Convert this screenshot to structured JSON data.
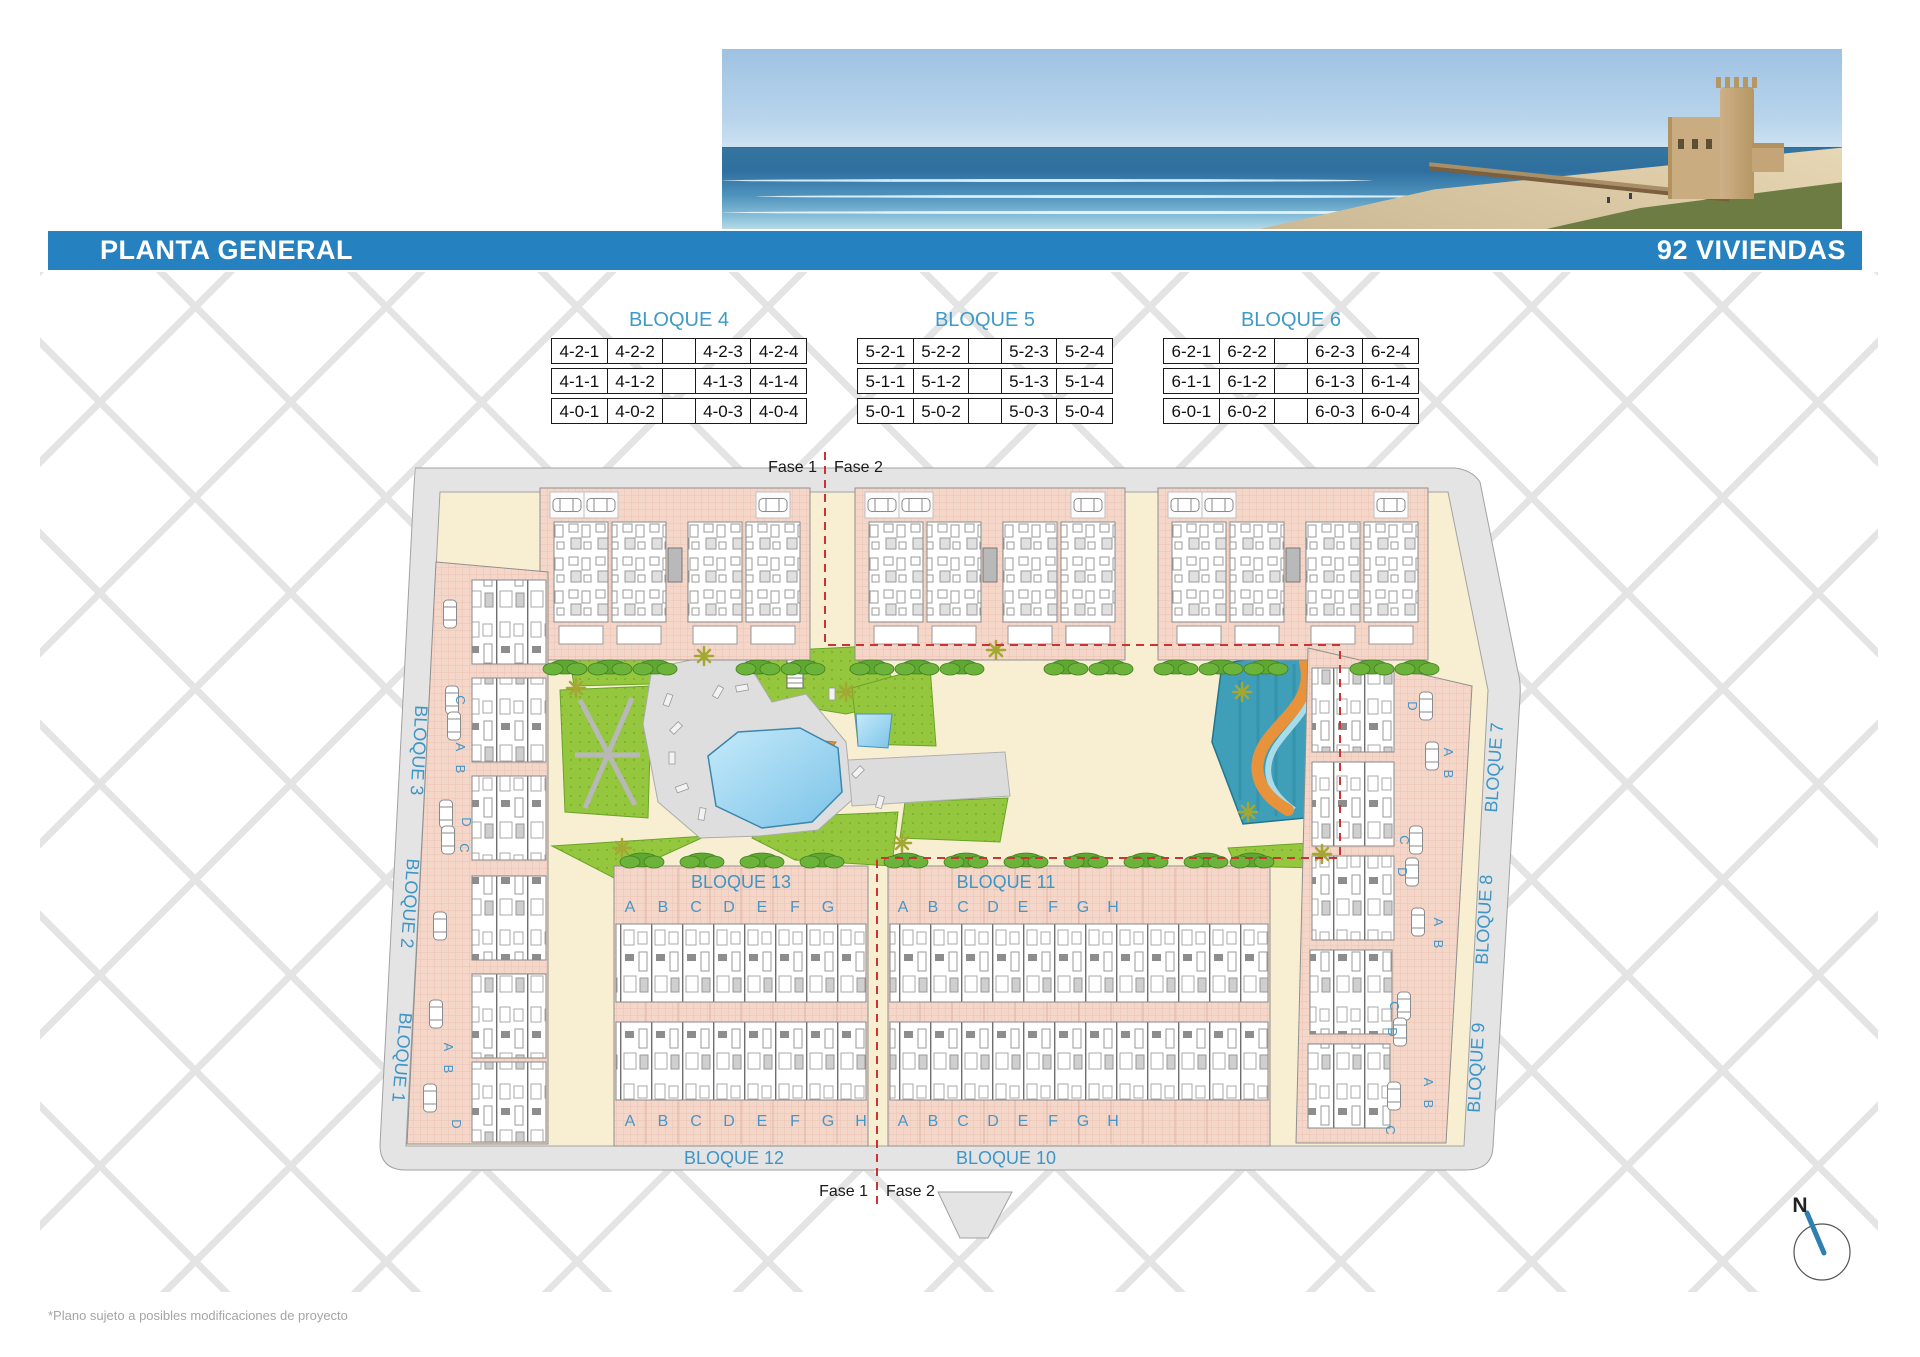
{
  "header": {
    "title": "PLANTA GENERAL",
    "badge": "92 VIVIENDAS"
  },
  "legend_tables": [
    {
      "title": "BLOQUE 4",
      "rows": [
        [
          "4-2-1",
          "4-2-2",
          "",
          "4-2-3",
          "4-2-4"
        ],
        [
          "4-1-1",
          "4-1-2",
          "",
          "4-1-3",
          "4-1-4"
        ],
        [
          "4-0-1",
          "4-0-2",
          "",
          "4-0-3",
          "4-0-4"
        ]
      ]
    },
    {
      "title": "BLOQUE 5",
      "rows": [
        [
          "5-2-1",
          "5-2-2",
          "",
          "5-2-3",
          "5-2-4"
        ],
        [
          "5-1-1",
          "5-1-2",
          "",
          "5-1-3",
          "5-1-4"
        ],
        [
          "5-0-1",
          "5-0-2",
          "",
          "5-0-3",
          "5-0-4"
        ]
      ]
    },
    {
      "title": "BLOQUE 6",
      "rows": [
        [
          "6-2-1",
          "6-2-2",
          "",
          "6-2-3",
          "6-2-4"
        ],
        [
          "6-1-1",
          "6-1-2",
          "",
          "6-1-3",
          "6-1-4"
        ],
        [
          "6-0-1",
          "6-0-2",
          "",
          "6-0-3",
          "6-0-4"
        ]
      ]
    }
  ],
  "phase": {
    "fase1": "Fase 1",
    "fase2": "Fase 2"
  },
  "plan": {
    "labels": {
      "b1": "BLOQUE 1",
      "b2": "BLOQUE 2",
      "b3": "BLOQUE 3",
      "b7": "BLOQUE 7",
      "b8": "BLOQUE 8",
      "b9": "BLOQUE 9",
      "b10": "BLOQUE 10",
      "b11": "BLOQUE 11",
      "b12": "BLOQUE 12",
      "b13": "BLOQUE 13"
    },
    "letters": [
      "A",
      "B",
      "C",
      "D",
      "E",
      "F",
      "G",
      "H"
    ],
    "side_left": [
      "C",
      "A",
      "B",
      "D",
      "C",
      "A",
      "B",
      "D"
    ],
    "side_right": [
      "D",
      "A",
      "B",
      "C",
      "D",
      "A",
      "B",
      "C",
      "D",
      "A",
      "B",
      "C"
    ]
  },
  "compass": {
    "north": "N"
  },
  "footer": {
    "disclaimer": "*Plano sujeto a posibles modificaciones de proyecto"
  },
  "colors": {
    "header_blue": "#2581c0",
    "label_blue": "#3e96c6",
    "phase_red": "#cc3333",
    "building_pink": "#f5d7c9",
    "path_cream": "#f8efd3",
    "pool_blue": "#8fd0ee",
    "garden_green": "#94c73e",
    "water_teal": "#3f9fb8",
    "deck_orange": "#e8923c"
  }
}
